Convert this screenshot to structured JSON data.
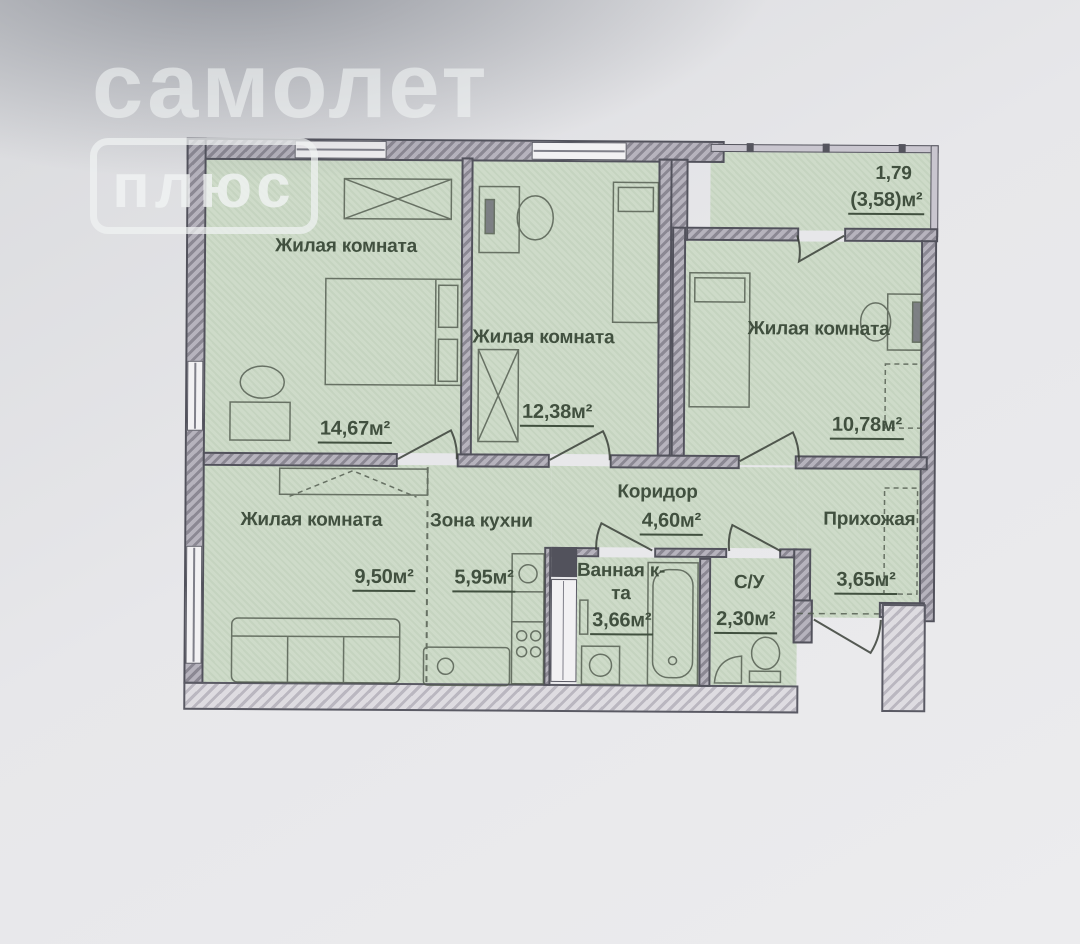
{
  "watermark": {
    "brand": "самолет",
    "badge": "плюс"
  },
  "plan": {
    "type": "apartment-floor-plan",
    "rooms": {
      "living1": {
        "name": "Жилая комната",
        "area": "14,67м²"
      },
      "living2": {
        "name": "Жилая комната",
        "area": "12,38м²"
      },
      "living3": {
        "name": "Жилая комната",
        "area": "10,78м²"
      },
      "living4": {
        "name": "Жилая комната",
        "area": "9,50м²"
      },
      "kitchen": {
        "name": "Зона кухни",
        "area": "5,95м²"
      },
      "corridor": {
        "name": "Коридор",
        "area": "4,60м²"
      },
      "hallway": {
        "name": "Прихожая",
        "area": "3,65м²"
      },
      "bathroom": {
        "name": "Ванная к-та",
        "area": "3,66м²"
      },
      "wc": {
        "name": "С/У",
        "area": "2,30м²"
      },
      "balcony": {
        "reduced_area": "1,79",
        "full_area": "(3,58)м²"
      }
    },
    "colors": {
      "room_fill": "#cbd9c6",
      "wall": "#8b8893",
      "wall_outline": "#52525c",
      "label_text": "#41503f",
      "paper": "#e9e9ec"
    }
  }
}
